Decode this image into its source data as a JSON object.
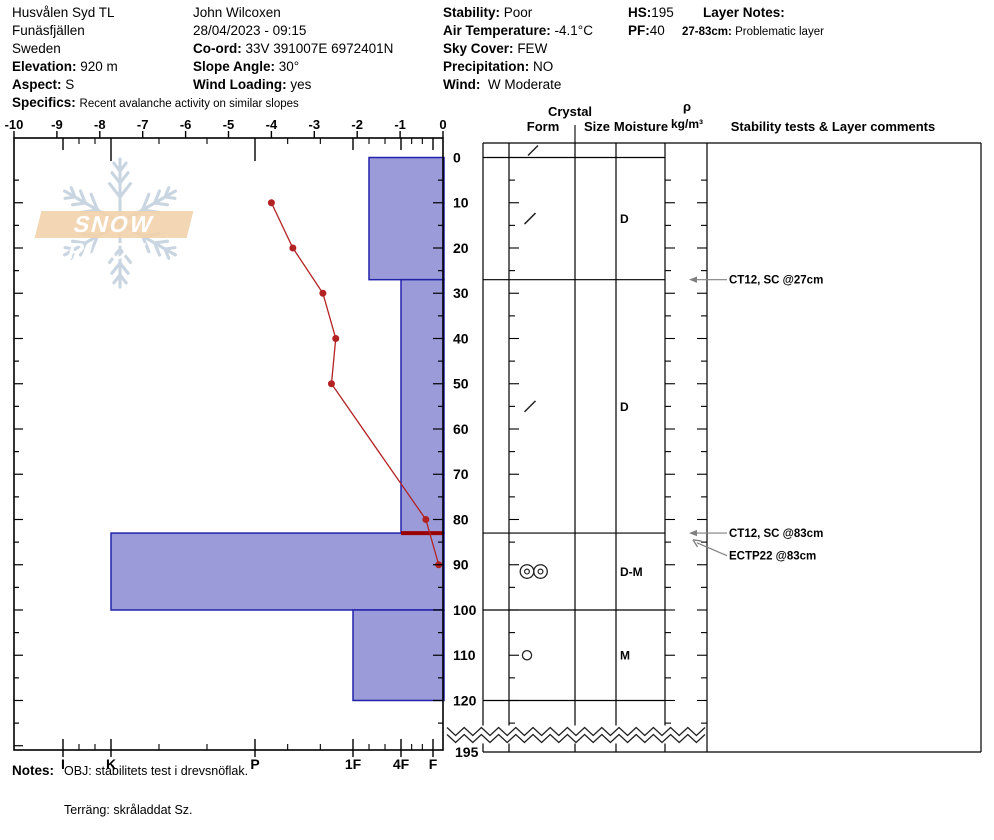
{
  "header": {
    "location": {
      "title": "Husvålen Syd TL",
      "region": "Funäsfjällen",
      "country": "Sweden",
      "elevation_label": "Elevation:",
      "elevation_value": "920 m",
      "aspect_label": "Aspect:",
      "aspect_value": "S",
      "specifics_label": "Specifics:",
      "specifics_value": "Recent avalanche activity on similar slopes"
    },
    "observation": {
      "observer": "John Wilcoxen",
      "datetime": "28/04/2023 - 09:15",
      "coord_label": "Co-ord:",
      "coord_value": "33V 391007E 6972401N",
      "slope_angle_label": "Slope Angle:",
      "slope_angle_value": "30°",
      "wind_loading_label": "Wind Loading:",
      "wind_loading_value": "yes"
    },
    "conditions": {
      "stability_label": "Stability:",
      "stability_value": "Poor",
      "air_temp_label": "Air Temperature:",
      "air_temp_value": "-4.1°C",
      "sky_cover_label": "Sky Cover:",
      "sky_cover_value": "FEW",
      "precip_label": "Precipitation:",
      "precip_value": "NO",
      "wind_label": "Wind:",
      "wind_value": "W Moderate"
    },
    "snowpack": {
      "hs_label": "HS:",
      "hs_value": "195",
      "pf_label": "PF:",
      "pf_value": "40"
    },
    "layer_notes": {
      "label": "Layer Notes:",
      "range": "27-83cm:",
      "text": "Problematic layer"
    }
  },
  "watermark": {
    "text": "SNOW PILOT"
  },
  "notes": {
    "label": "Notes:",
    "line1": "OBJ: stabilitets test i drevsnöflak.",
    "line2": "Terräng: skråladdat Sz."
  },
  "chart_data": {
    "type": "snow-profile",
    "temp_axis": {
      "min": -10,
      "max": 0,
      "tick_values": [
        -10,
        -9,
        -8,
        -7,
        -6,
        -5,
        -4,
        -3,
        -2,
        -1,
        0
      ],
      "units": "°C"
    },
    "depth_axis": {
      "tick_values": [
        0,
        10,
        20,
        30,
        40,
        50,
        60,
        70,
        80,
        90,
        100,
        110,
        120
      ],
      "break_label": "195",
      "units": "cm"
    },
    "hardness_axis": {
      "tick_labels": [
        "I",
        "K",
        "P",
        "1F",
        "4F",
        "F"
      ]
    },
    "temperature_profile": {
      "series_name": "snow temperature",
      "points": [
        {
          "depth_cm": 10,
          "temp_c": -4.0
        },
        {
          "depth_cm": 20,
          "temp_c": -3.5
        },
        {
          "depth_cm": 30,
          "temp_c": -2.8
        },
        {
          "depth_cm": 40,
          "temp_c": -2.5
        },
        {
          "depth_cm": 50,
          "temp_c": -2.6
        },
        {
          "depth_cm": 80,
          "temp_c": -0.4
        },
        {
          "depth_cm": 90,
          "temp_c": -0.1
        }
      ]
    },
    "surface_layer": {
      "form_symbol": "slash",
      "form_code": "DF"
    },
    "layers": [
      {
        "top_cm": 0,
        "bottom_cm": 27,
        "hardness": "1F-",
        "form_symbol": "slash",
        "form_code": "DF",
        "grain_size": "",
        "moisture": "D"
      },
      {
        "top_cm": 27,
        "bottom_cm": 83,
        "hardness": "4F",
        "form_symbol": "slash",
        "form_code": "DF",
        "grain_size": "",
        "moisture": "D"
      },
      {
        "top_cm": 83,
        "bottom_cm": 100,
        "hardness": "K",
        "form_symbol": "double-circle",
        "form_code": "MFcl",
        "grain_size": "",
        "moisture": "D-M"
      },
      {
        "top_cm": 100,
        "bottom_cm": 120,
        "hardness": "1F",
        "form_symbol": "circle",
        "form_code": "MF",
        "grain_size": "",
        "moisture": "M"
      }
    ],
    "problem_layer": {
      "depth_cm": 83
    },
    "stability_tests": [
      {
        "label": "CT12, SC @27cm",
        "arrow_depth_cm": 27,
        "label_depth_cm": 27
      },
      {
        "label": "CT12, SC @83cm",
        "arrow_depth_cm": 83,
        "label_depth_cm": 83
      },
      {
        "label": "ECTP22 @83cm",
        "arrow_depth_cm": 84.5,
        "label_depth_cm": 88
      }
    ],
    "table_headers": {
      "crystal": "Crystal",
      "form": "Form",
      "size": "Size",
      "moisture": "Moisture",
      "rho": "ρ",
      "rho_units": "kg/m³",
      "comments": "Stability tests & Layer comments"
    },
    "colors": {
      "bar_fill": "#9b9bd9",
      "bar_stroke": "#2222aa",
      "temp_line": "#b22222",
      "problem_layer": "#990000",
      "frame": "#000000",
      "arrow": "#808080",
      "watermark_flake": "#bccbd9",
      "watermark_banner": "#f2d2ad"
    }
  }
}
